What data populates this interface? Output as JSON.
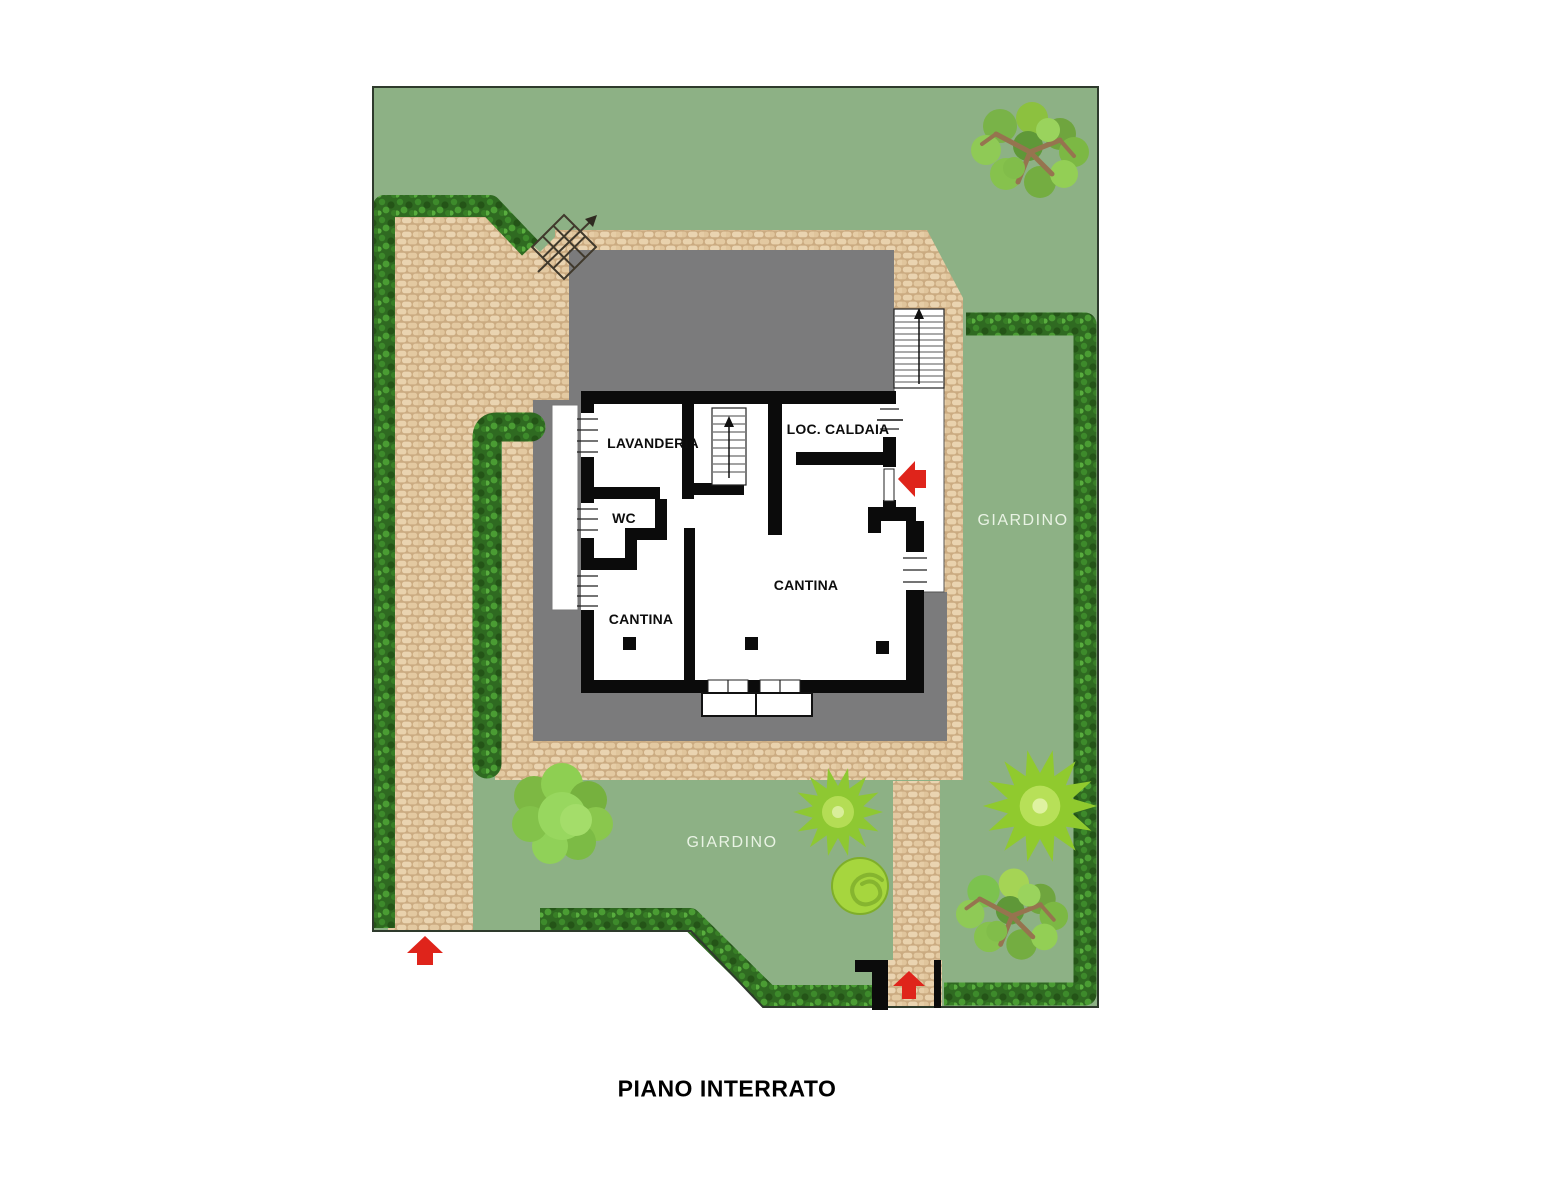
{
  "plan": {
    "title": "PIANO INTERRATO",
    "floor_labels": {
      "lavanderia": "LAVANDERIA",
      "loc_caldaia": "LOC. CALDAIA",
      "wc": "WC",
      "cantina_large": "CANTINA",
      "cantina_small": "CANTINA"
    },
    "garden_labels": {
      "right": "GIARDINO",
      "bottom": "GIARDINO"
    },
    "colors": {
      "grass": "#8db185",
      "paving_stone": "#e6cfa9",
      "paving_joint": "#cbab81",
      "hedge_green": "#2f6a21",
      "roof_gray": "#7b7b7c",
      "wall_black": "#0b0b0b",
      "arrow_red": "#df241b",
      "garden_label_text": "#e9f3e4",
      "boundary_line": "#2e3a2c"
    }
  }
}
